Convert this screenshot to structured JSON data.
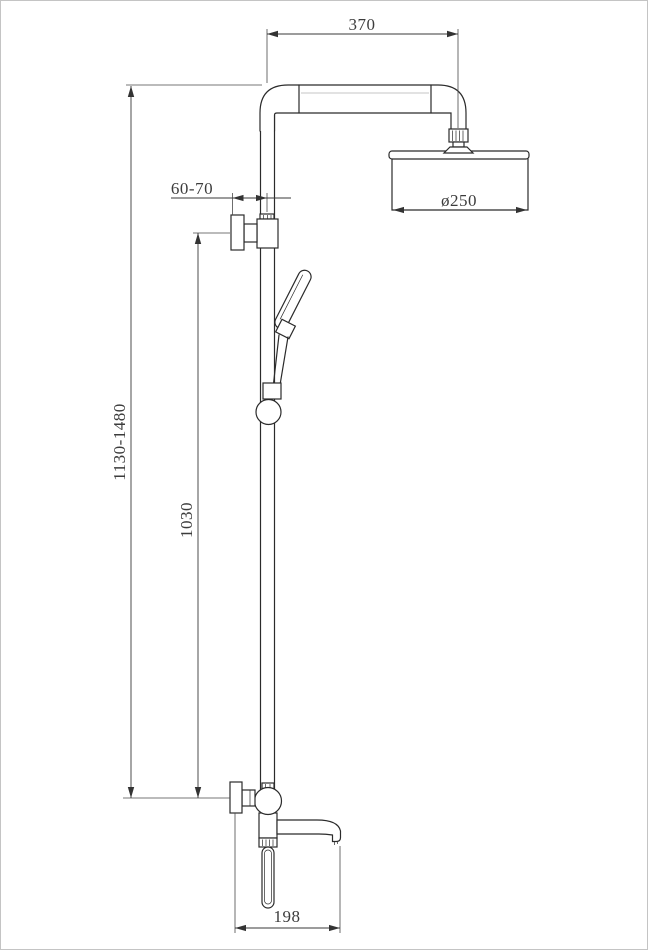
{
  "page": {
    "background": "#ffffff",
    "border_color": "#c4c4c4",
    "part_line_color": "#2b2b2b",
    "dimension_line_color": "#3a3a3a"
  },
  "dimensions": {
    "arm_length": "370",
    "head_diameter": "ø250",
    "wall_distance": "60-70",
    "overall_height": "1130-1480",
    "bar_height": "1030",
    "spout_length": "198"
  }
}
